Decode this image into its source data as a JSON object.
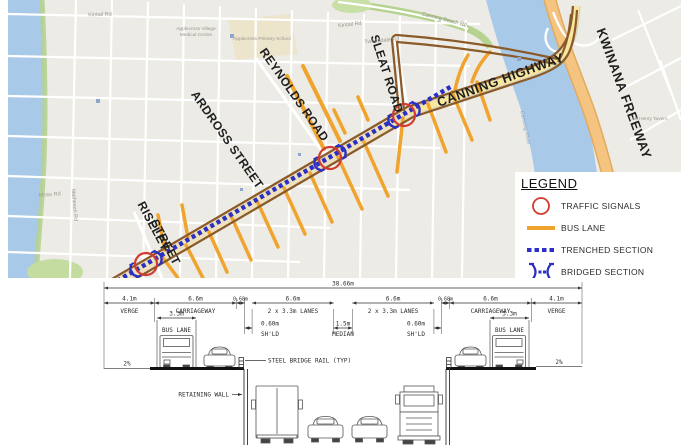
{
  "map": {
    "streets": {
      "reynolds": "REYNOLDS ROAD",
      "ardross": "ARDROSS STREET",
      "sleat": "SLEAT ROAD",
      "riseley_1": "RISELEY",
      "riseley_2": "STREET",
      "canning": "CANNING HIGHWAY",
      "kwinana": "KWINANA FREEWAY"
    },
    "minor_labels": {
      "kintail_1": "Kintail Rd",
      "kintail_2": "Kintail Rd",
      "tweeddale": "Tweeddale Rd",
      "canning_beach": "Canning Beach Rd",
      "river": "Canning River",
      "matheson": "Matheson Rd",
      "moss": "Moss Rd",
      "school": "Applecross Primary School",
      "medical_1": "Applecross Village",
      "medical_2": "Medical Centre",
      "tavern": "Mt Henry Tavern"
    }
  },
  "legend": {
    "title": "LEGEND",
    "items": [
      {
        "symbol": "traffic-signal",
        "label": "TRAFFIC SIGNALS"
      },
      {
        "symbol": "bus-lane",
        "label": "BUS LANE"
      },
      {
        "symbol": "trenched-section",
        "label": "TRENCHED SECTION"
      },
      {
        "symbol": "bridged-section",
        "label": "BRIDGED SECTION"
      }
    ]
  },
  "cross_section": {
    "overall": "38.66m",
    "segments": [
      {
        "dim": "4.1m",
        "label": "VERGE"
      },
      {
        "dim": "6.6m",
        "label": "CARRIAGEWAY"
      },
      {
        "dim": "0.68m",
        "label": ""
      },
      {
        "dim": "6.6m",
        "label": "2 x 3.3m LANES"
      },
      {
        "dim": "6.6m",
        "label": "2 x 3.3m LANES"
      },
      {
        "dim": "0.68m",
        "label": ""
      },
      {
        "dim": "6.6m",
        "label": "CARRIAGEWAY"
      },
      {
        "dim": "4.1m",
        "label": "VERGE"
      }
    ],
    "sub_dims": [
      {
        "dim": "0.60m",
        "label": "SH'LD"
      },
      {
        "dim": "1.5m",
        "label": "MEDIAN"
      },
      {
        "dim": "0.60m",
        "label": "SH'LD"
      }
    ],
    "bus_lane_dim": "3.3m",
    "bus_lane_label": "BUS LANE",
    "slope": "2%",
    "steel_bridge_rail": "STEEL BRIDGE RAIL (TYP)",
    "retaining_wall": "RETAINING WALL"
  },
  "colors": {
    "bus_lane": "#F0A42E",
    "trenched": "#2B2FC4",
    "traffic_signal": "#D23B2F",
    "route_brown": "#8A5A28",
    "highway_fill": "#F8E79E",
    "freeway_fill": "#F5C480",
    "water": "#A9C9E9",
    "map_bg": "#ECEBE5"
  }
}
